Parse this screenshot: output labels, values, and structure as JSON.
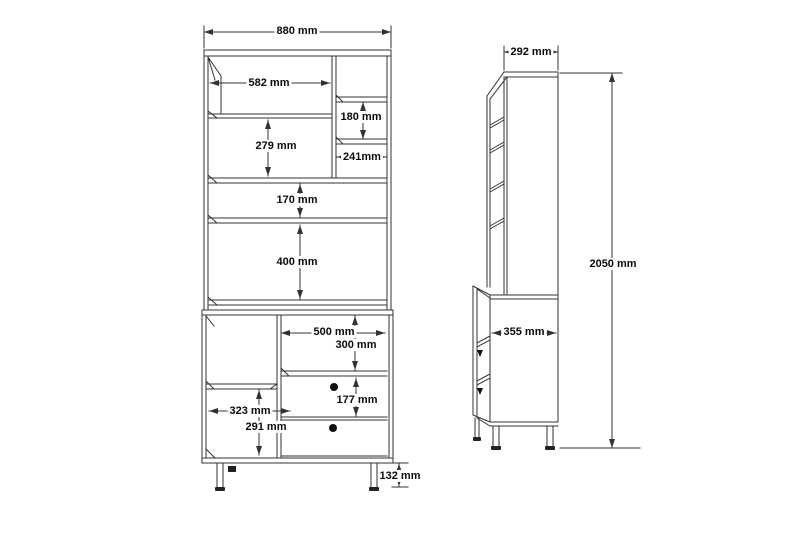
{
  "colors": {
    "background": "#ffffff",
    "line": "#333333",
    "text": "#0a0a0a"
  },
  "front_view": {
    "dimensions": {
      "overall_width": "880 mm",
      "top_shelf_width": "582 mm",
      "upper_right_shelf_height": "180 mm",
      "upper_right_shelf_width": "241mm",
      "upper_left_shelf_height": "279 mm",
      "middle_shelf_height": "170 mm",
      "lower_shelf_height": "400 mm",
      "base_opening_width": "500 mm",
      "base_opening_height": "300 mm",
      "drawer_height": "177 mm",
      "base_left_width": "323 mm",
      "base_left_height": "291 mm",
      "leg_height": "132 mm"
    }
  },
  "side_view": {
    "dimensions": {
      "top_depth": "292 mm",
      "base_depth": "355 mm",
      "overall_height": "2050 mm"
    }
  }
}
